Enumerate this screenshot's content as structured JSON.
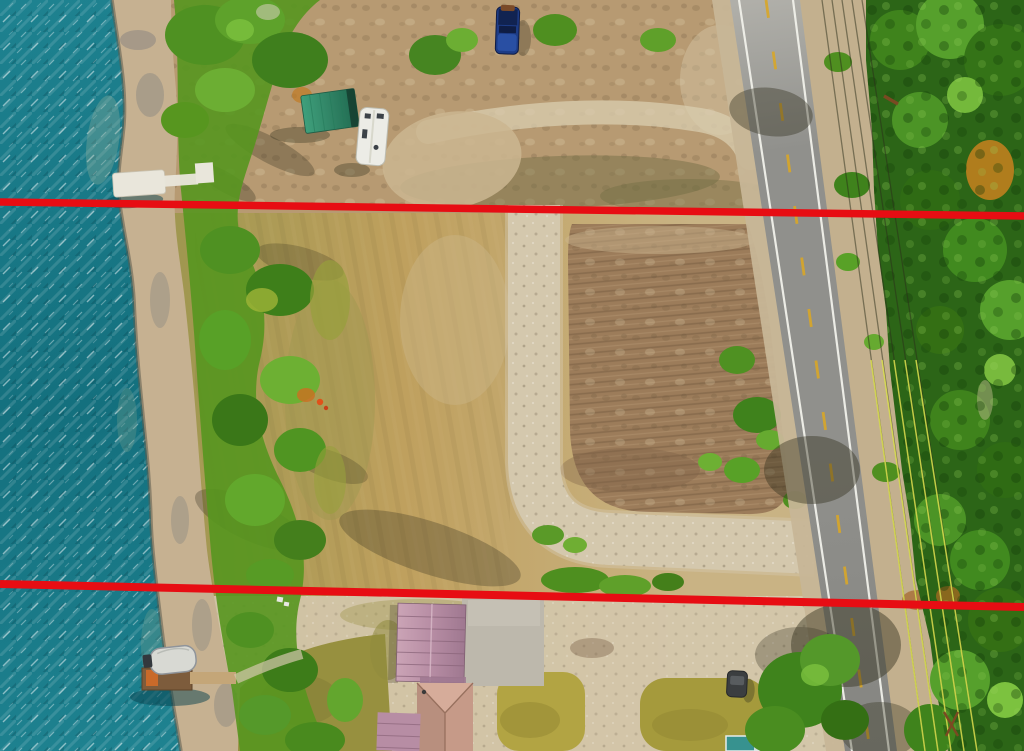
{
  "scene": {
    "type": "aerial-drone-photograph",
    "description": "Top-down aerial photo of a waterfront vacant land parcel between a teal lake shoreline (left) and a rural two-lane highway (right), with forest beyond the road. Two red surveyed property boundary lines are drawn across the full width of the image.",
    "annotations": {
      "boundary_line_color": "#e70d13",
      "lines": [
        {
          "name": "north-boundary-line",
          "x1": 0,
          "y1": 202,
          "x2": 1024,
          "y2": 216,
          "thickness": 7.5
        },
        {
          "name": "south-boundary-line",
          "x1": 0,
          "y1": 584,
          "x2": 1024,
          "y2": 607,
          "thickness": 8
        }
      ]
    },
    "objects": [
      {
        "name": "lake-water",
        "description": "teal lake with wave sparkle, left edge"
      },
      {
        "name": "shoreline-beach",
        "description": "sandy rocky beach band along waterline"
      },
      {
        "name": "shore-vegetation",
        "description": "green brush and trees along the shore"
      },
      {
        "name": "north-dock",
        "description": "white dock extending into water above north boundary"
      },
      {
        "name": "south-dock-and-boat",
        "description": "wooden dock with covered boat, bottom left"
      },
      {
        "name": "storage-shed",
        "description": "green metal-roof shed, upper parcel"
      },
      {
        "name": "rv-trailer",
        "description": "white RV trailer parked beside shed"
      },
      {
        "name": "pickup-truck",
        "description": "dark blue truck at top edge"
      },
      {
        "name": "grass-field",
        "description": "golden dry-grass lot between boundary lines"
      },
      {
        "name": "plowed-dirt-field",
        "description": "brown cleared/plowed pad framed by gravel drive"
      },
      {
        "name": "gravel-driveway",
        "description": "L-shaped light gravel driveway from highway"
      },
      {
        "name": "highway-road",
        "description": "two-lane asphalt highway, white edges, yellow dashes"
      },
      {
        "name": "power-lines",
        "description": "utility lines paralleling the highway"
      },
      {
        "name": "forest",
        "description": "dense green forest east of highway"
      },
      {
        "name": "house-roof-mauve",
        "description": "mauve metal roof building, bottom center"
      },
      {
        "name": "hip-roof-building",
        "description": "tan hip-roof building at bottom edge"
      },
      {
        "name": "parked-car",
        "description": "dark car near lawn patches, bottom"
      },
      {
        "name": "teal-structure",
        "description": "small teal roof at bottom edge"
      }
    ],
    "palette": {
      "water_base": "#1e8290",
      "water_deep": "#14707e",
      "water_light": "#35a0ac",
      "beach": "#c6b191",
      "beach_rock": "#9d9486",
      "wet_edge": "#5d5b4e",
      "north_ground": "#b79a72",
      "ground_pale": "#d9cdb0",
      "ground_olive": "#6f6b42",
      "field_gold": "#bfa05e",
      "field_olive": "#a09750",
      "field_tan": "#c9b384",
      "dirt_field": "#9c7c5a",
      "dirt_dark": "#7a5f45",
      "dirt_pale": "#cbb691",
      "gravel": "#d4c8ad",
      "gravel_dark": "#a79a80",
      "road_light": "#b0afa9",
      "road_mid": "#90908c",
      "road_dark": "#858581",
      "road_white": "#f1f1ea",
      "road_yellow": "#d9a728",
      "shoulder": "#c7b697",
      "shoulder_right": "#c3b08e",
      "forest_base": "#2c6517",
      "tree_dark": "#346f14",
      "tree_mid": "#3f831c",
      "tree_light": "#56a02c",
      "tree_bright": "#7cc23f",
      "tree_olive": "#97a03c",
      "tree_orange": "#c8811f",
      "veg_dark": "#3a7718",
      "veg_mid": "#4f9122",
      "veg_light": "#66aa30",
      "shadow": "#32301d",
      "shed_light": "#3fa07c",
      "shed_mid": "#2f8163",
      "shed_dark": "#1f6a50",
      "shed_end": "#143c2e",
      "rv_body": "#ecece6",
      "rv_line": "#bdbdb2",
      "rv_window": "#3c4248",
      "truck_body": "#1d3c86",
      "truck_dark": "#0f1d44",
      "truck_light": "#2b52a8",
      "truck_cargo": "#7a4a28",
      "dock_white": "#e9e6db",
      "dock_shadow": "#08424d",
      "wood_dark": "#7d5c3c",
      "wood_light": "#c4a678",
      "tarp_orange": "#c96a2a",
      "boat_cover": "#d8d9d3",
      "boat_rim": "#8f949a",
      "motor": "#33383d",
      "roof_mauve_light": "#cba4b6",
      "roof_mauve": "#b78da4",
      "roof_mauve_dark": "#9f7890",
      "roof_seam": "#8a6479",
      "hip_roof": "#c69a88",
      "hip_roof_light": "#d6ac9a",
      "hip_line": "#97705e",
      "apron": "#bdb8ac",
      "apron_light": "#cac5b9",
      "car_body": "#3b3e40",
      "car_glass": "#585c5f",
      "teal_roof": "#37928f",
      "white_trim": "#e6ecec",
      "lawn_olive": "#97903f",
      "grass_patch": "#b2a443",
      "grass_patch2": "#a59a3c",
      "power_dark": "#2b2e1a",
      "power_sun": "#dde24e",
      "pole_brown": "#7a4a22",
      "spot_orange": "#e0511a"
    }
  }
}
